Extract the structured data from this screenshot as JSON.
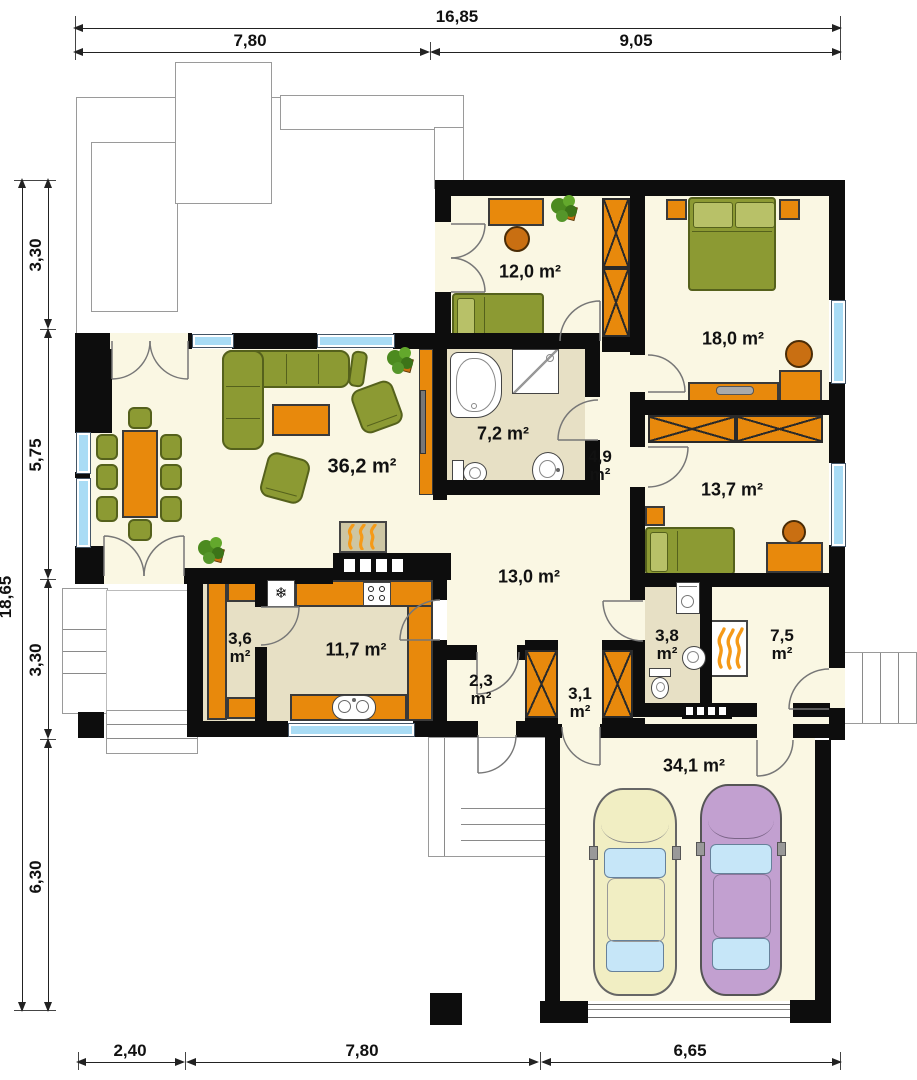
{
  "plan": {
    "title": "house-floor-plan",
    "dims": {
      "top_total": "16,85",
      "top_left": "7,80",
      "top_right": "9,05",
      "left_total": "18,65",
      "left_s1": "3,30",
      "left_s2": "5,75",
      "left_s3": "3,30",
      "left_s4": "6,30",
      "bottom_s1": "2,40",
      "bottom_s2": "7,80",
      "bottom_s3": "6,65"
    },
    "rooms": {
      "living": {
        "area": "36,2 m²"
      },
      "bedroom1": {
        "area": "12,0 m²"
      },
      "bedroom2": {
        "area": "18,0 m²"
      },
      "bathroom": {
        "area": "7,2 m²"
      },
      "hall": {
        "area": "4,9",
        "unit": "m²"
      },
      "bedroom3": {
        "area": "13,7 m²"
      },
      "corridor": {
        "area": "13,0 m²"
      },
      "pantry": {
        "area": "3,6",
        "unit": "m²"
      },
      "kitchen": {
        "area": "11,7 m²"
      },
      "closet": {
        "area": "2,3",
        "unit": "m²"
      },
      "vestibule": {
        "area": "3,1",
        "unit": "m²"
      },
      "wc": {
        "area": "3,8",
        "unit": "m²"
      },
      "boiler": {
        "area": "7,5",
        "unit": "m²"
      },
      "garage": {
        "area": "34,1 m²"
      }
    },
    "icons": {
      "fridge": "❄"
    },
    "colors": {
      "wall": "#0d0d0d",
      "floor": "#faf7e3",
      "floor_dark": "#e7e0c5",
      "orange": "#e8890c",
      "orange_dark": "#c96f12",
      "olive": "#8c9a33",
      "olive_dark": "#55611c",
      "window": "#a9dcf5",
      "terrace_line": "#9a9a9a",
      "car_yellow": "#f1eec3",
      "car_purple": "#c2a0d0",
      "glass": "#c6e6f8",
      "flame": "#f59a18",
      "fireplace_tan": "#cdc6a4"
    }
  }
}
